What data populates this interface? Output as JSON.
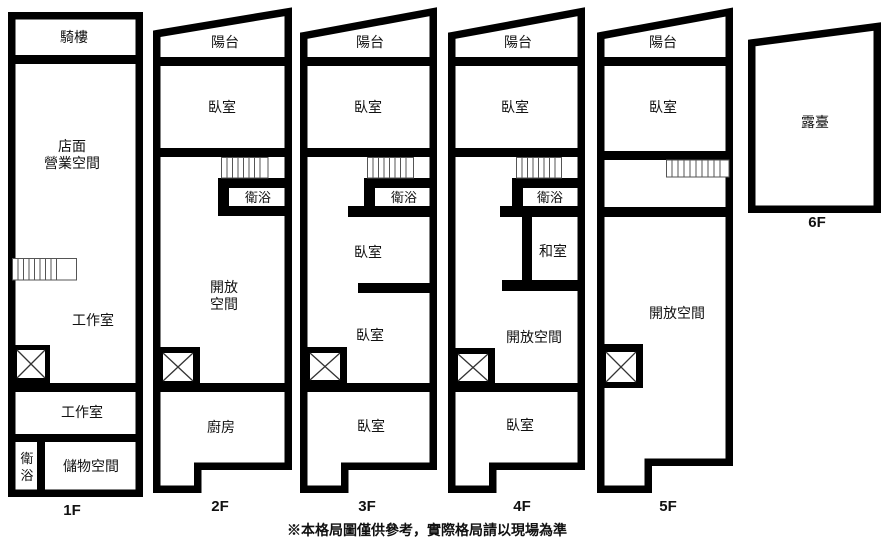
{
  "disclaimer": "※本格局圖僅供參考，實際格局請以現場為準",
  "floors": {
    "f1": {
      "label": "1F",
      "arcade": "騎樓",
      "storefront_line1": "店面",
      "storefront_line2": "營業空間",
      "workshop1": "工作室",
      "workshop2": "工作室",
      "bath_char1": "衛",
      "bath_char2": "浴",
      "storage": "儲物空間"
    },
    "f2": {
      "label": "2F",
      "balcony": "陽台",
      "bedroom": "臥室",
      "bath": "衛浴",
      "open_line1": "開放",
      "open_line2": "空間",
      "kitchen": "廚房"
    },
    "f3": {
      "label": "3F",
      "balcony": "陽台",
      "bedroom1": "臥室",
      "bath": "衛浴",
      "bedroom2": "臥室",
      "bedroom3": "臥室",
      "bedroom4": "臥室"
    },
    "f4": {
      "label": "4F",
      "balcony": "陽台",
      "bedroom1": "臥室",
      "bath": "衛浴",
      "tatami": "和室",
      "open": "開放空間",
      "bedroom2": "臥室"
    },
    "f5": {
      "label": "5F",
      "balcony": "陽台",
      "bedroom": "臥室",
      "open": "開放空間"
    },
    "f6": {
      "label": "6F",
      "terrace": "露臺"
    }
  }
}
